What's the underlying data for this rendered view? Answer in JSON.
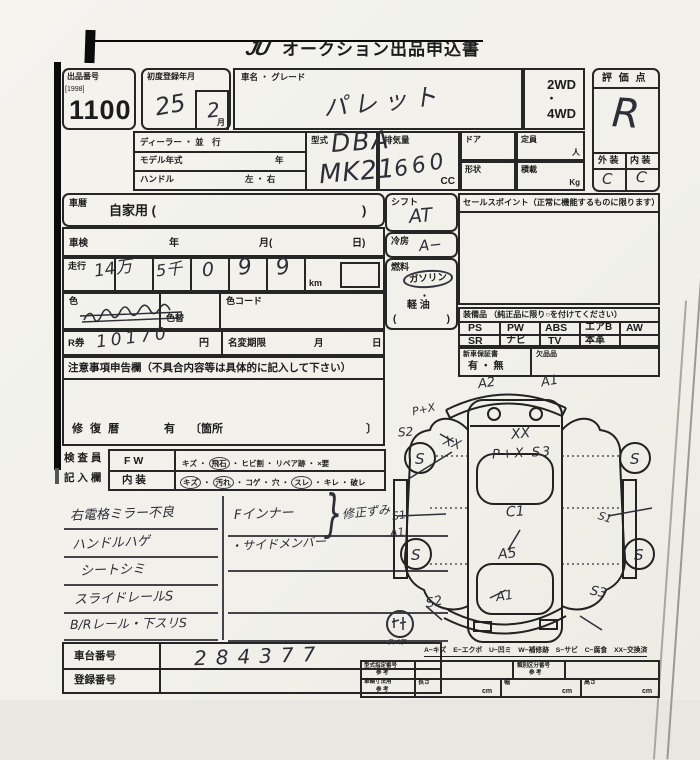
{
  "scan": {
    "title_logo": "JU",
    "title": "オークション出品申込書"
  },
  "lot": {
    "label": "出品番号",
    "tag": "[1998]",
    "number": "1100"
  },
  "reg": {
    "label": "初度登録年月",
    "year": "25",
    "month": "2",
    "month_label": "月"
  },
  "car": {
    "label": "車名 ・ グレード",
    "value": "パレット"
  },
  "drive": {
    "wd2": "2WD",
    "dot": "・",
    "wd4": "4WD"
  },
  "rating": {
    "label": "評 価 点",
    "value": "R",
    "ext_label": "外 装",
    "int_label": "内 装",
    "ext_value": "C",
    "int_value": "C"
  },
  "spec": {
    "dealer": "ディーラー ・ 並　行",
    "model_year": "モデル年式",
    "model_year_unit": "年",
    "handle": "ハンドル",
    "handle_opts": "左 ・ 右",
    "type_label": "型式",
    "type_line1": "DBA",
    "type_line2": "MK21",
    "disp_label": "排気量",
    "disp_value": "660",
    "disp_unit": "CC",
    "door_label": "ドア",
    "cap_label": "定員",
    "cap_unit": "人",
    "shape_label": "形状",
    "load_label": "積載",
    "load_unit": "Kg"
  },
  "history": {
    "label": "車暦",
    "value": "自家用 (",
    "close": ")"
  },
  "shaken": {
    "label": "車検",
    "year": "年",
    "month": "月(",
    "day": "日)"
  },
  "mileage": {
    "label": "走行",
    "d0": "14万",
    "d1": "5千",
    "d2": "0",
    "d3": "9",
    "d4": "9",
    "unit": "km"
  },
  "color": {
    "label": "色",
    "alt_label": "色替",
    "code_label": "色コード"
  },
  "shift": {
    "label": "シフト",
    "value": "AT"
  },
  "ac": {
    "label": "冷房",
    "value": "A−"
  },
  "fuel": {
    "label": "燃料",
    "gas": "ガソリン",
    "dot1": "・",
    "diesel": "軽 油",
    "paren_open": "(",
    "paren_close": ")"
  },
  "sales": {
    "header": "セールスポイント（正常に機能するものに限ります）"
  },
  "equip": {
    "header": "装備品 （純正品に限り○を付けてください）",
    "r1c0": "PS",
    "r1c1": "PW",
    "r1c2": "ABS",
    "r1c3": "エアB",
    "r1c4": "AW",
    "r2c0": "SR",
    "r2c1": "ナビ",
    "r2c2": "TV",
    "r2c3": "本革",
    "r2c4": ""
  },
  "warranty": {
    "label": "新車保証書",
    "opts": "有 ・ 無",
    "missing": "欠品品"
  },
  "rticket": {
    "label": "R券",
    "value": "10170",
    "unit": "円",
    "rename": "名変期限",
    "month": "月",
    "day": "日"
  },
  "caution": {
    "header": "注意事項申告欄（不具合内容等は具体的に記入して下さい）",
    "repair": "修 復 暦",
    "yes": "有",
    "loc": "〔箇所",
    "close": "〕"
  },
  "inspector": {
    "who1": "検 査 員",
    "who2": "記 入 欄",
    "fw": "FW",
    "interior": "内 装",
    "sep": " ・ ",
    "fw_items": [
      "キズ",
      "飛石",
      "ヒビ割",
      "リペア跡",
      "×要"
    ],
    "fw_circled": [
      false,
      true,
      false,
      false,
      false
    ],
    "int_items": [
      "キズ",
      "汚れ",
      "コゲ",
      "穴",
      "スレ",
      "キレ",
      "破レ"
    ],
    "int_circled": [
      true,
      true,
      false,
      false,
      true,
      false,
      false
    ]
  },
  "handnotes": {
    "left": [
      "右電格ミラー不良",
      "ハンドルハゲ",
      "シートシミ",
      "スライドレールS",
      "B/Rレール・下スリS"
    ],
    "right_line1": "Fインナー",
    "right_line2": "・サイドメンバー",
    "brace": "}",
    "right_note": "修正ずみ"
  },
  "ids": {
    "chassis_label": "車台番号",
    "chassis_value": "284377",
    "reg_label": "登録番号"
  },
  "legend": {
    "text": "A−キズ　E−エクボ　U−凹ミ　W−補修跡　S−サビ　C−腐食　XX−交換済"
  },
  "dims": {
    "t1": "型式指定番号",
    "t1s": "参 考",
    "t2": "類別区分番号",
    "t2s": "参 考",
    "t3": "車輌寸法用",
    "t3s": "参 考",
    "len": "長さ",
    "wid": "幅",
    "hei": "高さ",
    "cm": "cm"
  },
  "diagram": {
    "marks": {
      "front_l": "A2",
      "front_r": "A1",
      "fl_px": "P+X",
      "fl_s2": "S2",
      "fl_xx": "XX",
      "hood_xx": "XX",
      "hood_pxs3": "P+X S3",
      "side_l_s1": "S1",
      "side_l_a1": "A1",
      "center_c1": "C1",
      "center_a5": "A5",
      "rear_a1": "A1",
      "rear_l_s2": "S2",
      "rear_r_s3": "S3",
      "side_r_s1": "S1",
      "wheel": "S"
    },
    "spare": "スペア"
  }
}
